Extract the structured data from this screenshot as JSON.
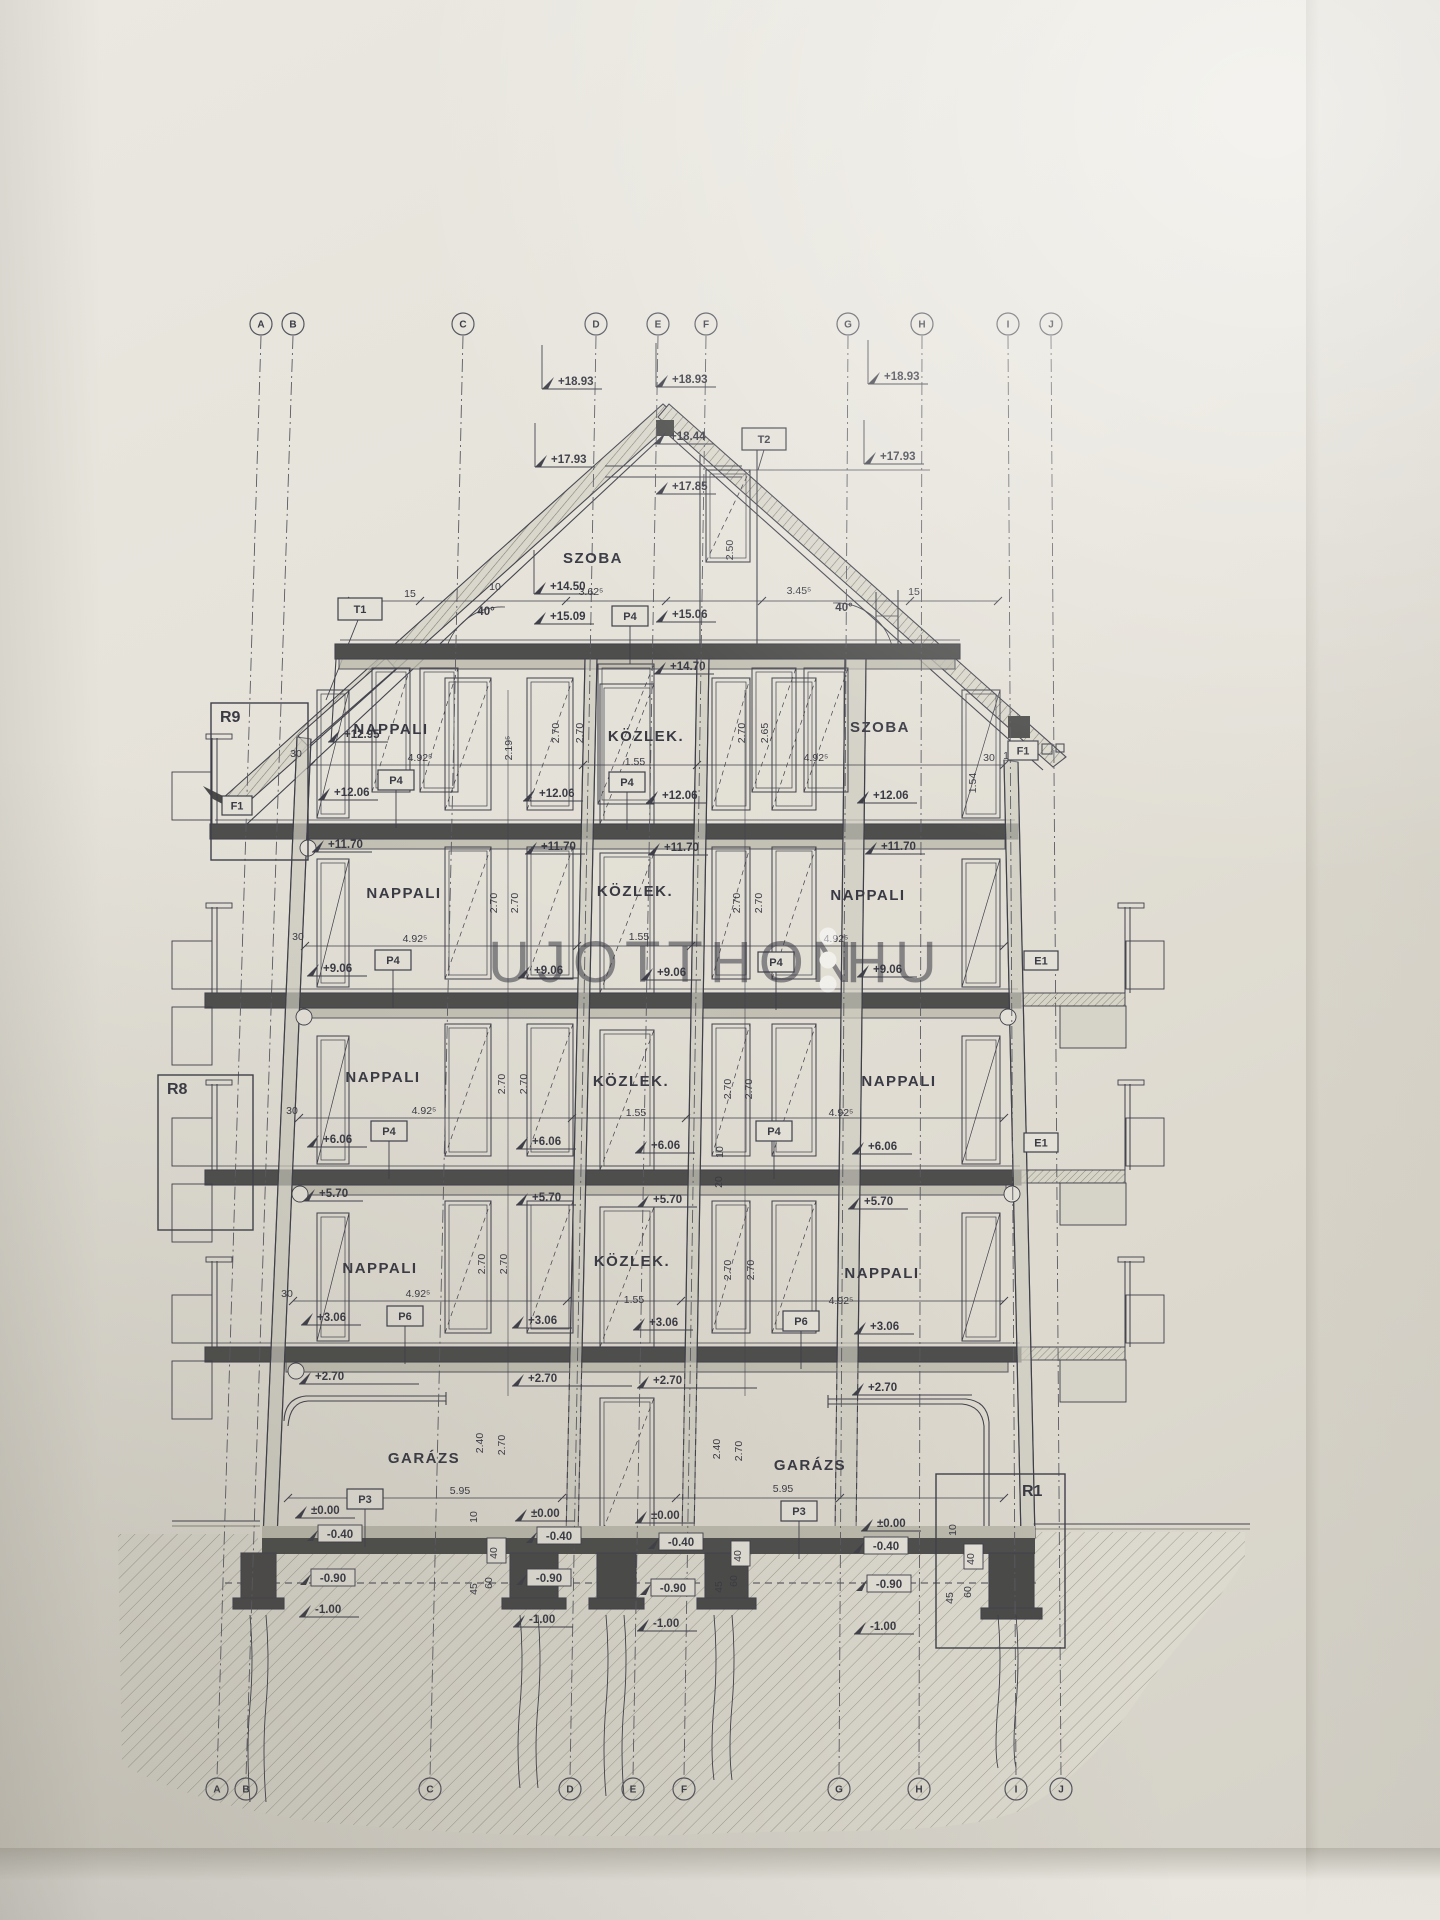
{
  "document": {
    "type": "building-section-drawing",
    "language": "hu"
  },
  "colors": {
    "ink": "#3f3f49",
    "slab": "#4e4e4c",
    "paper": "#e3e0d7",
    "watermark": "#ffffff",
    "earth_hatch": "#94917f"
  },
  "watermark": {
    "text_main": "UJOTTHON",
    "text_suffix": "HU",
    "separator_icon": "dotted-pin-icon"
  },
  "grid": {
    "letters": [
      "A",
      "B",
      "C",
      "D",
      "E",
      "F",
      "G",
      "H",
      "I",
      "J"
    ],
    "top_x": [
      261,
      293,
      463,
      596,
      658,
      706,
      848,
      922,
      1008,
      1051
    ],
    "bottom_x": [
      217,
      246,
      430,
      570,
      633,
      684,
      839,
      919,
      1016,
      1061
    ],
    "top_y": 324,
    "bottom_y": 1789
  },
  "rooms": [
    {
      "label": "SZOBA",
      "x": 593,
      "y": 563
    },
    {
      "label": "NAPPALI",
      "x": 391,
      "y": 734
    },
    {
      "label": "KÖZLEK.",
      "x": 646,
      "y": 741
    },
    {
      "label": "SZOBA",
      "x": 880,
      "y": 732
    },
    {
      "label": "NAPPALI",
      "x": 404,
      "y": 898
    },
    {
      "label": "KÖZLEK.",
      "x": 635,
      "y": 896
    },
    {
      "label": "NAPPALI",
      "x": 868,
      "y": 900
    },
    {
      "label": "NAPPALI",
      "x": 383,
      "y": 1082
    },
    {
      "label": "KÖZLEK.",
      "x": 631,
      "y": 1086
    },
    {
      "label": "NAPPALI",
      "x": 899,
      "y": 1086
    },
    {
      "label": "NAPPALI",
      "x": 380,
      "y": 1273
    },
    {
      "label": "KÖZLEK.",
      "x": 632,
      "y": 1266
    },
    {
      "label": "NAPPALI",
      "x": 882,
      "y": 1278
    },
    {
      "label": "GARÁZS",
      "x": 424,
      "y": 1463
    },
    {
      "label": "GARÁZS",
      "x": 810,
      "y": 1470
    }
  ],
  "elevations": [
    {
      "v": "+18.93",
      "x": 558,
      "y": 385,
      "stem": true
    },
    {
      "v": "+18.93",
      "x": 672,
      "y": 383,
      "stem": true
    },
    {
      "v": "+18.93",
      "x": 884,
      "y": 380,
      "stem": true
    },
    {
      "v": "+17.93",
      "x": 551,
      "y": 463,
      "stem": true
    },
    {
      "v": "+18.44",
      "x": 670,
      "y": 440
    },
    {
      "v": "+17.85",
      "x": 672,
      "y": 490
    },
    {
      "v": "+17.93",
      "x": 880,
      "y": 460,
      "stem": true
    },
    {
      "v": "+14.50",
      "x": 550,
      "y": 590,
      "stem": true
    },
    {
      "v": "+15.09",
      "x": 550,
      "y": 620
    },
    {
      "v": "+15.06",
      "x": 672,
      "y": 618
    },
    {
      "v": "+14.70",
      "x": 670,
      "y": 670
    },
    {
      "v": "+12.95",
      "x": 344,
      "y": 738
    },
    {
      "v": "+12.06",
      "x": 334,
      "y": 796
    },
    {
      "v": "+12.06",
      "x": 539,
      "y": 797
    },
    {
      "v": "+12.06",
      "x": 662,
      "y": 799
    },
    {
      "v": "+12.06",
      "x": 873,
      "y": 799
    },
    {
      "v": "+11.70",
      "x": 328,
      "y": 848
    },
    {
      "v": "+11.70",
      "x": 541,
      "y": 850
    },
    {
      "v": "+11.70",
      "x": 664,
      "y": 851
    },
    {
      "v": "+11.70",
      "x": 881,
      "y": 850
    },
    {
      "v": "+9.06",
      "x": 323,
      "y": 972
    },
    {
      "v": "+9.06",
      "x": 534,
      "y": 974
    },
    {
      "v": "+9.06",
      "x": 657,
      "y": 976
    },
    {
      "v": "+9.06",
      "x": 873,
      "y": 973
    },
    {
      "v": "+6.06",
      "x": 323,
      "y": 1143
    },
    {
      "v": "+6.06",
      "x": 532,
      "y": 1145
    },
    {
      "v": "+6.06",
      "x": 651,
      "y": 1149
    },
    {
      "v": "+6.06",
      "x": 868,
      "y": 1150
    },
    {
      "v": "+5.70",
      "x": 319,
      "y": 1197
    },
    {
      "v": "+5.70",
      "x": 532,
      "y": 1201
    },
    {
      "v": "+5.70",
      "x": 653,
      "y": 1203
    },
    {
      "v": "+5.70",
      "x": 864,
      "y": 1205
    },
    {
      "v": "+3.06",
      "x": 317,
      "y": 1321
    },
    {
      "v": "+3.06",
      "x": 528,
      "y": 1324
    },
    {
      "v": "+3.06",
      "x": 649,
      "y": 1326
    },
    {
      "v": "+3.06",
      "x": 870,
      "y": 1330
    },
    {
      "v": "+2.70",
      "x": 315,
      "y": 1380,
      "w": 120
    },
    {
      "v": "+2.70",
      "x": 528,
      "y": 1382,
      "w": 120
    },
    {
      "v": "+2.70",
      "x": 653,
      "y": 1384,
      "w": 120
    },
    {
      "v": "+2.70",
      "x": 868,
      "y": 1391,
      "w": 120
    },
    {
      "v": "±0.00",
      "x": 311,
      "y": 1514
    },
    {
      "v": "±0.00",
      "x": 531,
      "y": 1517
    },
    {
      "v": "±0.00",
      "x": 651,
      "y": 1519
    },
    {
      "v": "±0.00",
      "x": 877,
      "y": 1527
    },
    {
      "v": "-1.00",
      "x": 315,
      "y": 1613
    },
    {
      "v": "-1.00",
      "x": 529,
      "y": 1623
    },
    {
      "v": "-1.00",
      "x": 653,
      "y": 1627
    },
    {
      "v": "-1.00",
      "x": 870,
      "y": 1630
    }
  ],
  "boxed_elevations": [
    {
      "v": "-0.40",
      "x": 322,
      "y": 1538
    },
    {
      "v": "-0.40",
      "x": 541,
      "y": 1540
    },
    {
      "v": "-0.40",
      "x": 663,
      "y": 1546
    },
    {
      "v": "-0.40",
      "x": 868,
      "y": 1550
    },
    {
      "v": "-0.90",
      "x": 315,
      "y": 1582
    },
    {
      "v": "-0.90",
      "x": 531,
      "y": 1582
    },
    {
      "v": "-0.90",
      "x": 655,
      "y": 1592
    },
    {
      "v": "-0.90",
      "x": 871,
      "y": 1588
    }
  ],
  "dimensions": [
    {
      "v": "15",
      "x": 410,
      "y": 597
    },
    {
      "v": "10",
      "x": 495,
      "y": 590
    },
    {
      "v": "3.62⁵",
      "x": 591,
      "y": 595
    },
    {
      "v": "3.45⁵",
      "x": 799,
      "y": 594
    },
    {
      "v": "15",
      "x": 914,
      "y": 595
    },
    {
      "v": "40°",
      "x": 486,
      "y": 615,
      "big": true
    },
    {
      "v": "40°",
      "x": 844,
      "y": 611,
      "big": true
    },
    {
      "v": "2.50",
      "x": 733,
      "y": 550,
      "rot": true
    },
    {
      "v": "2.19⁵",
      "x": 512,
      "y": 748,
      "rot": true
    },
    {
      "v": "30",
      "x": 296,
      "y": 757
    },
    {
      "v": "30",
      "x": 298,
      "y": 940
    },
    {
      "v": "30",
      "x": 292,
      "y": 1114
    },
    {
      "v": "30",
      "x": 287,
      "y": 1297
    },
    {
      "v": "30",
      "x": 989,
      "y": 761
    },
    {
      "v": "15",
      "x": 1009,
      "y": 759
    },
    {
      "v": "1.54",
      "x": 976,
      "y": 783,
      "rot": true
    },
    {
      "v": "4.92⁵",
      "x": 420,
      "y": 761
    },
    {
      "v": "4.92⁵",
      "x": 415,
      "y": 942
    },
    {
      "v": "4.92⁵",
      "x": 424,
      "y": 1114
    },
    {
      "v": "4.92⁵",
      "x": 418,
      "y": 1297
    },
    {
      "v": "4.92⁵",
      "x": 816,
      "y": 761
    },
    {
      "v": "4.92⁵",
      "x": 836,
      "y": 942
    },
    {
      "v": "4.92⁵",
      "x": 841,
      "y": 1116
    },
    {
      "v": "4.92⁵",
      "x": 841,
      "y": 1304
    },
    {
      "v": "1.55",
      "x": 635,
      "y": 765
    },
    {
      "v": "1.55",
      "x": 639,
      "y": 940
    },
    {
      "v": "1.55",
      "x": 636,
      "y": 1116
    },
    {
      "v": "1.55",
      "x": 634,
      "y": 1303
    },
    {
      "v": "2.70",
      "x": 559,
      "y": 733,
      "rot": true
    },
    {
      "v": "2.70",
      "x": 583,
      "y": 733,
      "rot": true
    },
    {
      "v": "2.70",
      "x": 745,
      "y": 733,
      "rot": true
    },
    {
      "v": "2.65",
      "x": 768,
      "y": 733,
      "rot": true
    },
    {
      "v": "2.70",
      "x": 497,
      "y": 903,
      "rot": true
    },
    {
      "v": "2.70",
      "x": 518,
      "y": 903,
      "rot": true
    },
    {
      "v": "2.70",
      "x": 740,
      "y": 903,
      "rot": true
    },
    {
      "v": "2.70",
      "x": 762,
      "y": 903,
      "rot": true
    },
    {
      "v": "2.70",
      "x": 505,
      "y": 1084,
      "rot": true
    },
    {
      "v": "2.70",
      "x": 527,
      "y": 1084,
      "rot": true
    },
    {
      "v": "2.70",
      "x": 731,
      "y": 1089,
      "rot": true
    },
    {
      "v": "2.70",
      "x": 752,
      "y": 1089,
      "rot": true
    },
    {
      "v": "2.70",
      "x": 485,
      "y": 1264,
      "rot": true
    },
    {
      "v": "2.70",
      "x": 507,
      "y": 1264,
      "rot": true
    },
    {
      "v": "2.70",
      "x": 731,
      "y": 1270,
      "rot": true
    },
    {
      "v": "2.70",
      "x": 754,
      "y": 1270,
      "rot": true
    },
    {
      "v": "2.40",
      "x": 483,
      "y": 1443,
      "rot": true
    },
    {
      "v": "2.70",
      "x": 505,
      "y": 1445,
      "rot": true
    },
    {
      "v": "2.40",
      "x": 720,
      "y": 1449,
      "rot": true
    },
    {
      "v": "2.70",
      "x": 742,
      "y": 1451,
      "rot": true
    },
    {
      "v": "5.95",
      "x": 460,
      "y": 1494
    },
    {
      "v": "5.95",
      "x": 783,
      "y": 1492
    },
    {
      "v": "10",
      "x": 477,
      "y": 1517,
      "rot": true
    },
    {
      "v": "10",
      "x": 956,
      "y": 1530,
      "rot": true
    },
    {
      "v": "45",
      "x": 477,
      "y": 1589,
      "rot": true
    },
    {
      "v": "45",
      "x": 722,
      "y": 1587,
      "rot": true
    },
    {
      "v": "45",
      "x": 953,
      "y": 1598,
      "rot": true
    },
    {
      "v": "60",
      "x": 492,
      "y": 1583,
      "rot": true
    },
    {
      "v": "60",
      "x": 737,
      "y": 1581,
      "rot": true
    },
    {
      "v": "60",
      "x": 971,
      "y": 1592,
      "rot": true
    },
    {
      "v": "10",
      "x": 723,
      "y": 1152,
      "rot": true
    },
    {
      "v": "20",
      "x": 722,
      "y": 1182,
      "rot": true
    }
  ],
  "boxed_dimensions": [
    {
      "v": "40",
      "x": 496,
      "y": 1552
    },
    {
      "v": "40",
      "x": 740,
      "y": 1555
    },
    {
      "v": "40",
      "x": 973,
      "y": 1558
    }
  ],
  "detail_tags": [
    {
      "id": "T1",
      "x": 338,
      "y": 598,
      "w": 44,
      "h": 22
    },
    {
      "id": "T2",
      "x": 742,
      "y": 428,
      "w": 44,
      "h": 22
    },
    {
      "id": "P4",
      "x": 612,
      "y": 606,
      "w": 36,
      "h": 20,
      "leader": true
    },
    {
      "id": "P4",
      "x": 378,
      "y": 770,
      "w": 36,
      "h": 20,
      "leader": true
    },
    {
      "id": "P4",
      "x": 609,
      "y": 772,
      "w": 36,
      "h": 20,
      "leader": true
    },
    {
      "id": "P4",
      "x": 375,
      "y": 950,
      "w": 36,
      "h": 20,
      "leader": true
    },
    {
      "id": "P4",
      "x": 758,
      "y": 952,
      "w": 36,
      "h": 20,
      "leader": true
    },
    {
      "id": "P4",
      "x": 371,
      "y": 1121,
      "w": 36,
      "h": 20,
      "leader": true
    },
    {
      "id": "P4",
      "x": 756,
      "y": 1121,
      "w": 36,
      "h": 20,
      "leader": true
    },
    {
      "id": "P6",
      "x": 387,
      "y": 1306,
      "w": 36,
      "h": 20,
      "leader": true
    },
    {
      "id": "P6",
      "x": 783,
      "y": 1311,
      "w": 36,
      "h": 20,
      "leader": true
    },
    {
      "id": "P3",
      "x": 347,
      "y": 1489,
      "w": 36,
      "h": 20,
      "leader": true
    },
    {
      "id": "P3",
      "x": 781,
      "y": 1501,
      "w": 36,
      "h": 20,
      "leader": true
    },
    {
      "id": "F1",
      "x": 222,
      "y": 796,
      "w": 30,
      "h": 19
    },
    {
      "id": "F1",
      "x": 1008,
      "y": 741,
      "w": 30,
      "h": 19
    },
    {
      "id": "E1",
      "x": 1024,
      "y": 951,
      "w": 34,
      "h": 19
    },
    {
      "id": "E1",
      "x": 1024,
      "y": 1133,
      "w": 34,
      "h": 19
    }
  ],
  "detail_regions": [
    {
      "id": "R9",
      "rx": 211,
      "ry": 703,
      "rw": 97,
      "rh": 157,
      "lx": 220,
      "ly": 722
    },
    {
      "id": "R8",
      "rx": 158,
      "ry": 1075,
      "rw": 95,
      "rh": 155,
      "lx": 167,
      "ly": 1094
    },
    {
      "id": "R1",
      "rx": 936,
      "ry": 1474,
      "rw": 129,
      "rh": 174,
      "lx": 1022,
      "ly": 1496
    }
  ]
}
